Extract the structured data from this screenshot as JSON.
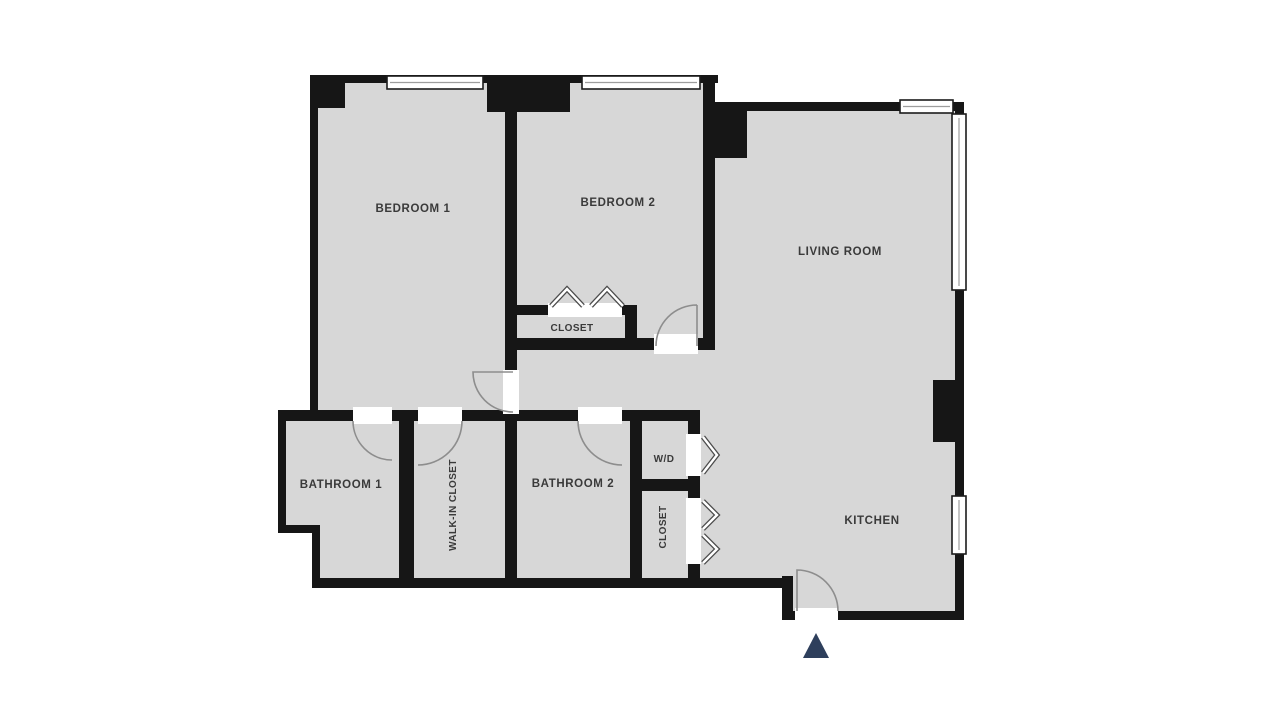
{
  "floorplan": {
    "rooms": {
      "bedroom1": {
        "label": "BEDROOM 1"
      },
      "bedroom2": {
        "label": "BEDROOM 2"
      },
      "living_room": {
        "label": "LIVING ROOM"
      },
      "closet_bedroom2": {
        "label": "CLOSET"
      },
      "bathroom1": {
        "label": "BATHROOM 1"
      },
      "walk_in_closet": {
        "label": "WALK-IN CLOSET"
      },
      "bathroom2": {
        "label": "BATHROOM 2"
      },
      "washer_dryer": {
        "label": "W/D"
      },
      "closet_hall": {
        "label": "CLOSET"
      },
      "kitchen": {
        "label": "KITCHEN"
      }
    },
    "colors": {
      "background": "#ffffff",
      "floor": "#d7d7d7",
      "wall": "#161616",
      "label": "#3a3a3a",
      "door_arc": "#8d8d8d",
      "entrance_arrow": "#2e3f5c"
    }
  }
}
